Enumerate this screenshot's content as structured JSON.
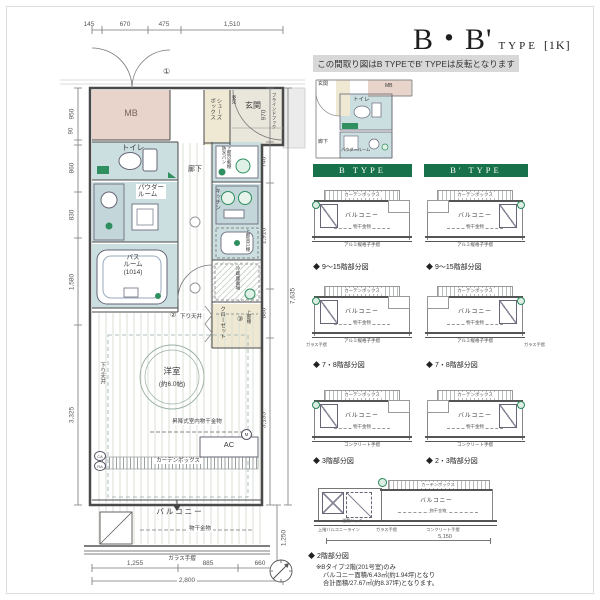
{
  "header": {
    "title_main": "B・B'",
    "title_type": "TYPE",
    "title_size": "[1K]",
    "banner": "この間取り図はB TYPEでB' TYPEは反転となります"
  },
  "plan": {
    "rooms": {
      "mb": "MB",
      "shoes_box": "シューズ\nボックス",
      "entrance": "玄関",
      "mirror": "姿見",
      "blind_hook": "ブラインドフック",
      "toilet": "トイレ",
      "powder_room": "パウダー\nルーム",
      "corridor": "廊下",
      "laundry_shelf": "上部可動棚\n防水パン",
      "kitchen": "キッチン",
      "hanging_cupboard": "上部吊戸棚",
      "fridge_space": "冷蔵庫置場",
      "bath_room": "バス\nルーム\n(1014)",
      "closet": "クローゼット",
      "upper_shelf": "上部棚",
      "west_room": "洋室",
      "west_room_size": "(約6.0帖)",
      "lowered_ceiling": "下り天井",
      "drying_unit": "昇降式室内物干金物",
      "ac": "AC",
      "curtain_box": "カーテンボックス",
      "balcony": "バルコニー",
      "drying_fixture": "物干金物",
      "glass_railing": "ガラス手摺"
    },
    "markers": {
      "m1": "①",
      "m2": "②",
      "m3": "③",
      "ca": "CA",
      "ra": "RA",
      "m": "M"
    },
    "dims": {
      "top": [
        "145",
        "670",
        "475",
        "1,510"
      ],
      "left": [
        "950",
        "90",
        "860",
        "830",
        "1,580",
        "3,325"
      ],
      "right": [
        "970",
        "740",
        "1,910",
        "880",
        "3,135"
      ],
      "right_total": "7,635",
      "balcony_depth": "1,250",
      "bottom": [
        "1,255",
        "885",
        "660"
      ],
      "bottom_total": "2,800"
    },
    "inset": {
      "entrance": "玄関",
      "mb": "MB",
      "toilet": "トイレ",
      "corridor": "廊下",
      "powder": "パウダールーム"
    }
  },
  "panels": {
    "b_header": "B TYPE",
    "bp_header": "B' TYPE",
    "mini": {
      "curtain_box": "カーテンボックス",
      "balcony": "バルコニー",
      "drying_fixture": "物干金物",
      "railing_aluminum": "アルミ縦格子手摺",
      "railing_concrete": "コンクリート手摺",
      "corner_note": "ガラス手摺"
    },
    "captions": {
      "row1": "◆ 9〜15階部分図",
      "row2": "◆ 7・8階部分図",
      "row3_b": "◆ 3階部分図",
      "row3_bp": "◆ 2・3階部分図",
      "bottom": "◆ 2階部分図"
    },
    "bottom_diagram": {
      "hatch": "避難ハッチ",
      "curtain_box": "カーテンボックス",
      "balcony": "バルコニー",
      "drying_fixture": "物干金物",
      "upper_balcony_line": "上階バルコニーライン",
      "glass_railing": "ガラス手摺",
      "concrete_railing": "コンクリート手摺",
      "width_dim": "5,150"
    },
    "notes": [
      "※Bタイプ:2階(201号室)のみ",
      "バルコニー面積/6.43㎡(約1.94坪)となり",
      "合計面積/27.67㎡(約8.37坪)となります。"
    ]
  },
  "colors": {
    "header_green": "#17714a",
    "wet_area_blue": "#ccdfe0",
    "mb_pink": "#e8d4ca",
    "closet_cream": "#efe9d3",
    "fixture_green": "#2f8f5f",
    "banner_gray": "#d8d8d8"
  }
}
